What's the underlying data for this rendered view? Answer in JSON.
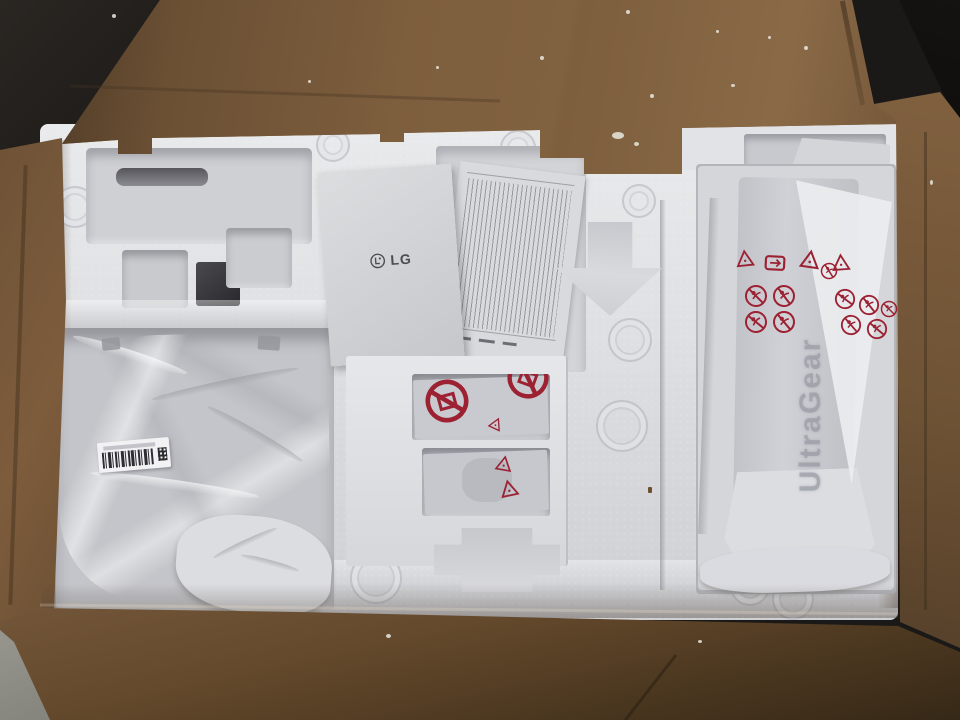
{
  "scene": {
    "description": "Top-down photo of an opened brown cardboard shipping box containing white molded foam packaging for an LG UltraGear monitor: an LG manual and folded warranty papers in the middle, accessory bags in foam windows, a plastic-wrapped stand base on the left with a barcode sticker, and a plastic-wrapped UltraGear stand column on the right with red safety printing.",
    "manual": {
      "brand": "LG"
    },
    "stand": {
      "brand": "UltraGear"
    },
    "colors": {
      "cardboard": "#7b5c3c",
      "cardboard_dark": "#4a3624",
      "foam": "#e0e1e4",
      "foam_shadow": "#b4b5bb",
      "plastic_wrap": "#d5d6da",
      "warning_red": "#9c2133",
      "paper": "#d6d7d9",
      "floor_dark": "#1b1917",
      "concrete": "#8f9089",
      "barcode_ink": "#2e2e32"
    },
    "icons": [
      {
        "name": "lg-logo",
        "meaning": "LG brand mark on manual cover"
      },
      {
        "name": "recycle-triangle-icon",
        "meaning": "recyclable plastic triangle symbol"
      },
      {
        "name": "plastic-film-recycle-icon",
        "meaning": "film recycling loop symbol"
      },
      {
        "name": "suffocation-warning-icon",
        "meaning": "keep plastic bag away from children warning"
      },
      {
        "name": "crossed-box-warning-icon",
        "meaning": "crossed-out handling warning on accessory bag"
      },
      {
        "name": "down-arrow-cutout",
        "meaning": "molded directional arrow in foam"
      },
      {
        "name": "barcode-label",
        "meaning": "part barcode sticker on wrapped base"
      }
    ]
  }
}
